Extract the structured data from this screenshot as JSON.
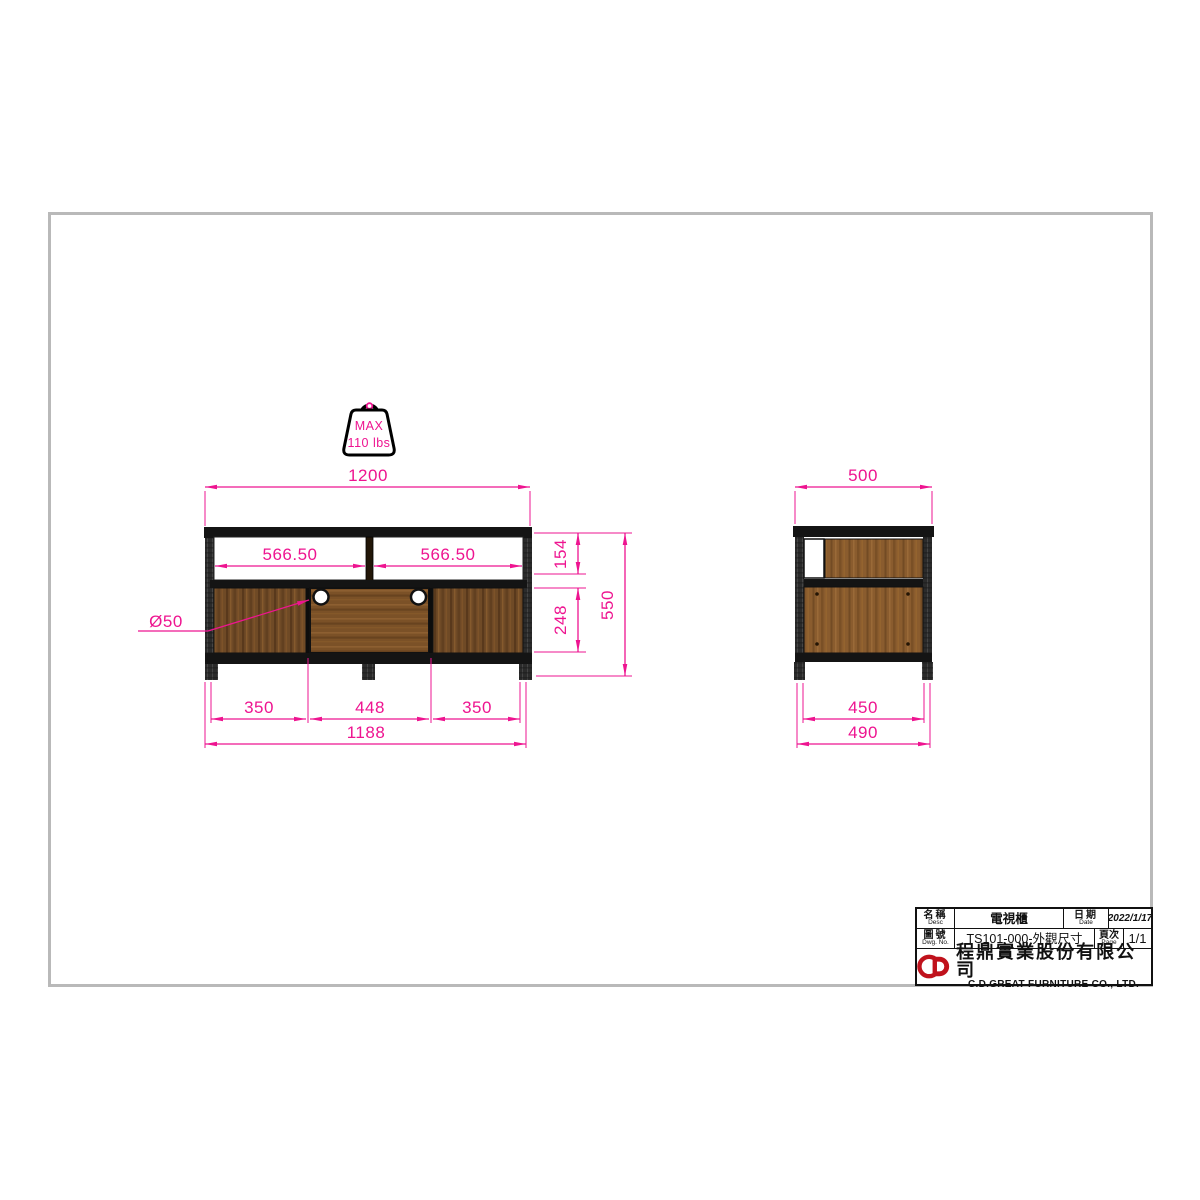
{
  "colors": {
    "dim_pink": "#ee1490",
    "frame_dark": "#161616",
    "sheet_border_gray": "#b9b9b9",
    "logo_red": "#c0121c",
    "wood_brown": "#6f4a26"
  },
  "badge": {
    "line1": "MAX",
    "line2": "110 lbs"
  },
  "front_view": {
    "dims": {
      "top_width": "1200",
      "shelf_left": "566.50",
      "shelf_right": "566.50",
      "shelf_height": "154",
      "door_height": "248",
      "total_height": "550",
      "hole_diameter": "Ø50",
      "bottom_left": "350",
      "bottom_center": "448",
      "bottom_right": "350",
      "bottom_width": "1188"
    }
  },
  "side_view": {
    "dims": {
      "top_depth": "500",
      "inner_depth": "450",
      "bottom_depth": "490"
    }
  },
  "title_block": {
    "name_label_zh": "名稱",
    "name_label_en": "Desc",
    "name_value": "電視櫃",
    "date_label_zh": "日期",
    "date_label_en": "Date",
    "date_value": "2022/1/17",
    "dwg_label_zh": "圖號",
    "dwg_label_en": "Dwg. No.",
    "dwg_value": "TS101-000-外觀尺寸",
    "page_label_zh": "頁次",
    "page_label_en": "Page",
    "page_value": "1/1",
    "company_zh": "程鼎實業股份有限公司",
    "company_en": "C.D.GREAT FURNITURE CO., LTD."
  }
}
